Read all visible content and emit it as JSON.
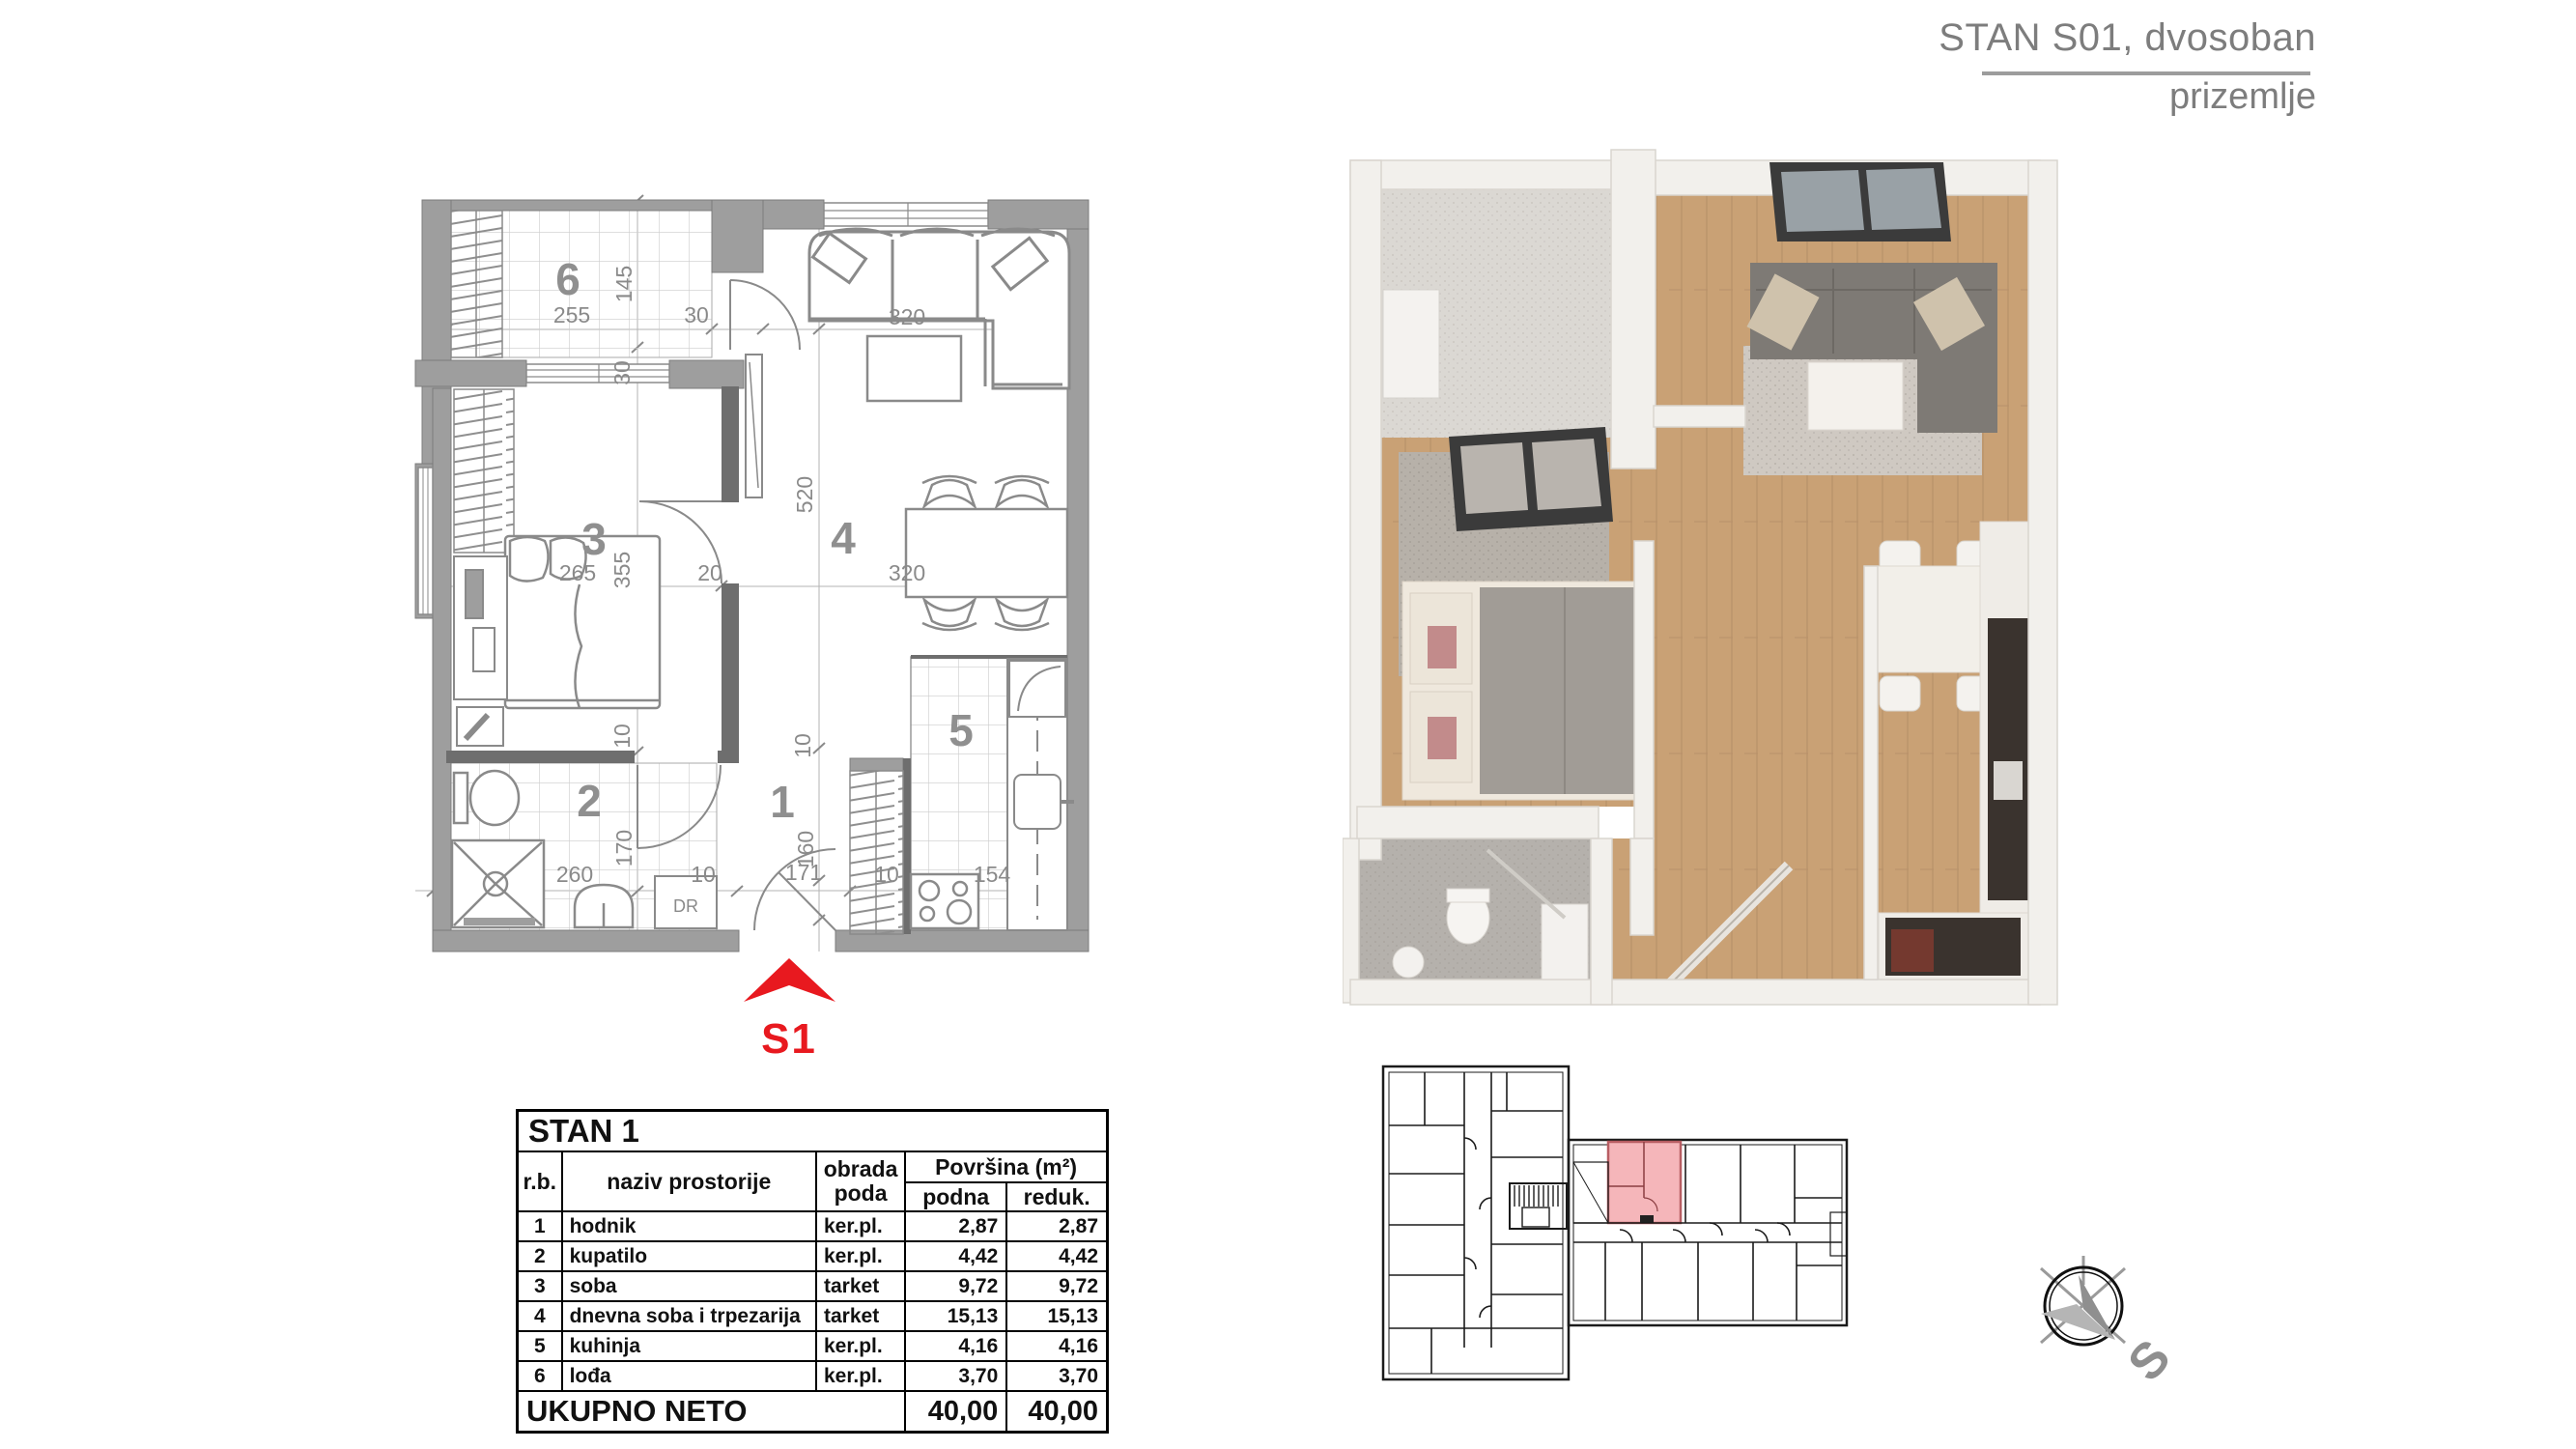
{
  "header": {
    "title": "STAN S01, dvosoban",
    "subtitle": "prizemlje"
  },
  "plan2d": {
    "rooms": {
      "r1": "1",
      "r2": "2",
      "r3": "3",
      "r4": "4",
      "r5": "5",
      "r6": "6"
    },
    "labels": {
      "entry": "S1",
      "closet": "DR"
    },
    "dims": {
      "w255": "255",
      "w30": "30",
      "w320s": "320",
      "h145": "145",
      "h30": "30",
      "h355": "355",
      "v10a": "10",
      "h520": "520",
      "v10b": "10",
      "h160": "160",
      "h170": "170",
      "w265": "265",
      "w20": "20",
      "w320t": "320",
      "w260": "260",
      "w10a": "10",
      "w171": "171",
      "w10b": "10",
      "w154": "154"
    }
  },
  "table": {
    "title": "STAN 1",
    "col_rb": "r.b.",
    "col_naziv": "naziv  prostorije",
    "col_obrada": "obrada poda",
    "col_povrsina": "Površina (m²)",
    "col_podna": "podna",
    "col_reduk": "reduk.",
    "rows": [
      {
        "rb": "1",
        "naziv": "hodnik",
        "obrada": "ker.pl.",
        "podna": "2,87",
        "reduk": "2,87"
      },
      {
        "rb": "2",
        "naziv": "kupatilo",
        "obrada": "ker.pl.",
        "podna": "4,42",
        "reduk": "4,42"
      },
      {
        "rb": "3",
        "naziv": "soba",
        "obrada": "tarket",
        "podna": "9,72",
        "reduk": "9,72"
      },
      {
        "rb": "4",
        "naziv": "dnevna soba i trpezarija",
        "obrada": "tarket",
        "podna": "15,13",
        "reduk": "15,13"
      },
      {
        "rb": "5",
        "naziv": "kuhinja",
        "obrada": "ker.pl.",
        "podna": "4,16",
        "reduk": "4,16"
      },
      {
        "rb": "6",
        "naziv": "lođa",
        "obrada": "ker.pl.",
        "podna": "3,70",
        "reduk": "3,70"
      }
    ],
    "total_label": "UKUPNO NETO",
    "total_podna": "40,00",
    "total_reduk": "40,00"
  },
  "overview": {
    "compass": "S"
  },
  "colors": {
    "accent_red": "#e8191f",
    "highlight_pink": "#f5b6ba",
    "wall_gray": "#9e9e9e",
    "dim_gray": "#8a8a8a",
    "wood": "#c9a175"
  }
}
